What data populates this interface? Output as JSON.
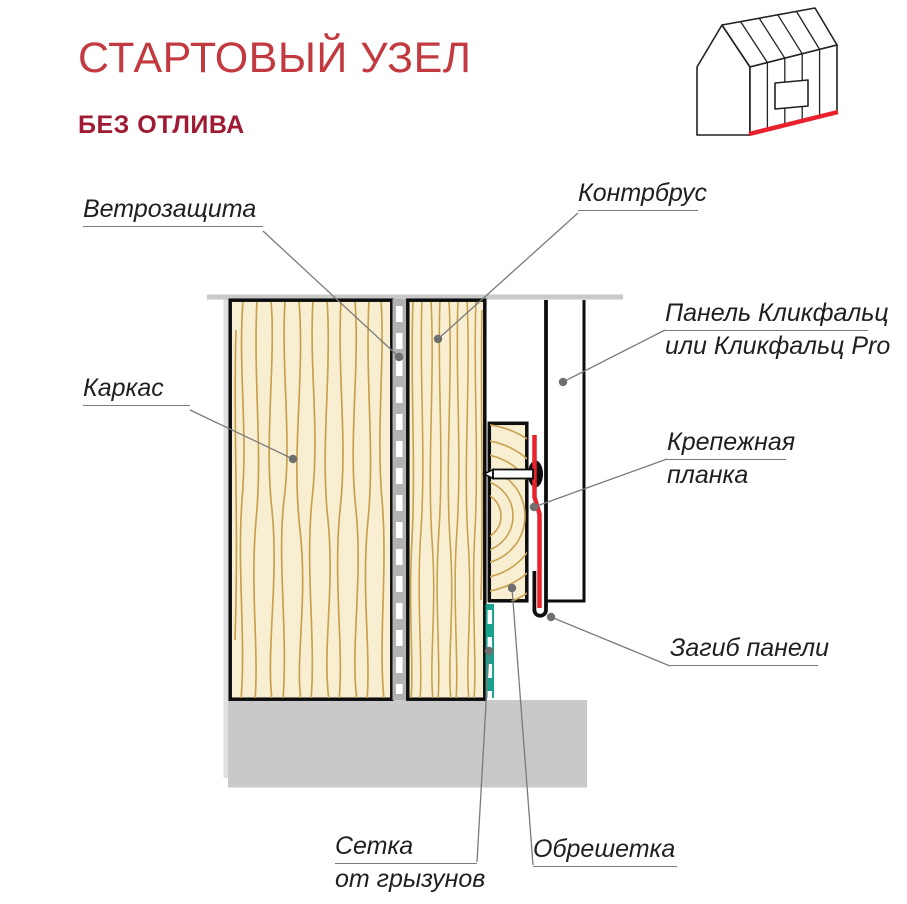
{
  "page": {
    "title": "СТАРТОВЫЙ УЗЕЛ",
    "subtitle": "БЕЗ ОТЛИВА"
  },
  "icons": {
    "house_icon": "house-gable-with-start-edge-highlighted"
  },
  "colors": {
    "title_red": "#C23A40",
    "subtitle_red": "#9E1B33",
    "accent_red": "#E8232D",
    "wood_fill": "#F8EFD3",
    "wood_grain": "#C8A14E",
    "mesh_teal": "#18A18C",
    "concrete_gray": "#C9C9C9",
    "membrane_gray": "#B2B2B2",
    "leader_gray": "#7a7a7a"
  },
  "diagram": {
    "labels": {
      "windbreak": "Ветрозащита",
      "counter_batten": "Контрбрус",
      "frame": "Каркас",
      "panel_line1": "Панель Кликфальц",
      "panel_line2": "или Кликфальц Pro",
      "fastening_line1": "Крепежная",
      "fastening_line2": "планка",
      "panel_bend": "Загиб панели",
      "mesh_line1": "Сетка",
      "mesh_line2": "от грызунов",
      "lathing": "Обрешетка"
    }
  }
}
